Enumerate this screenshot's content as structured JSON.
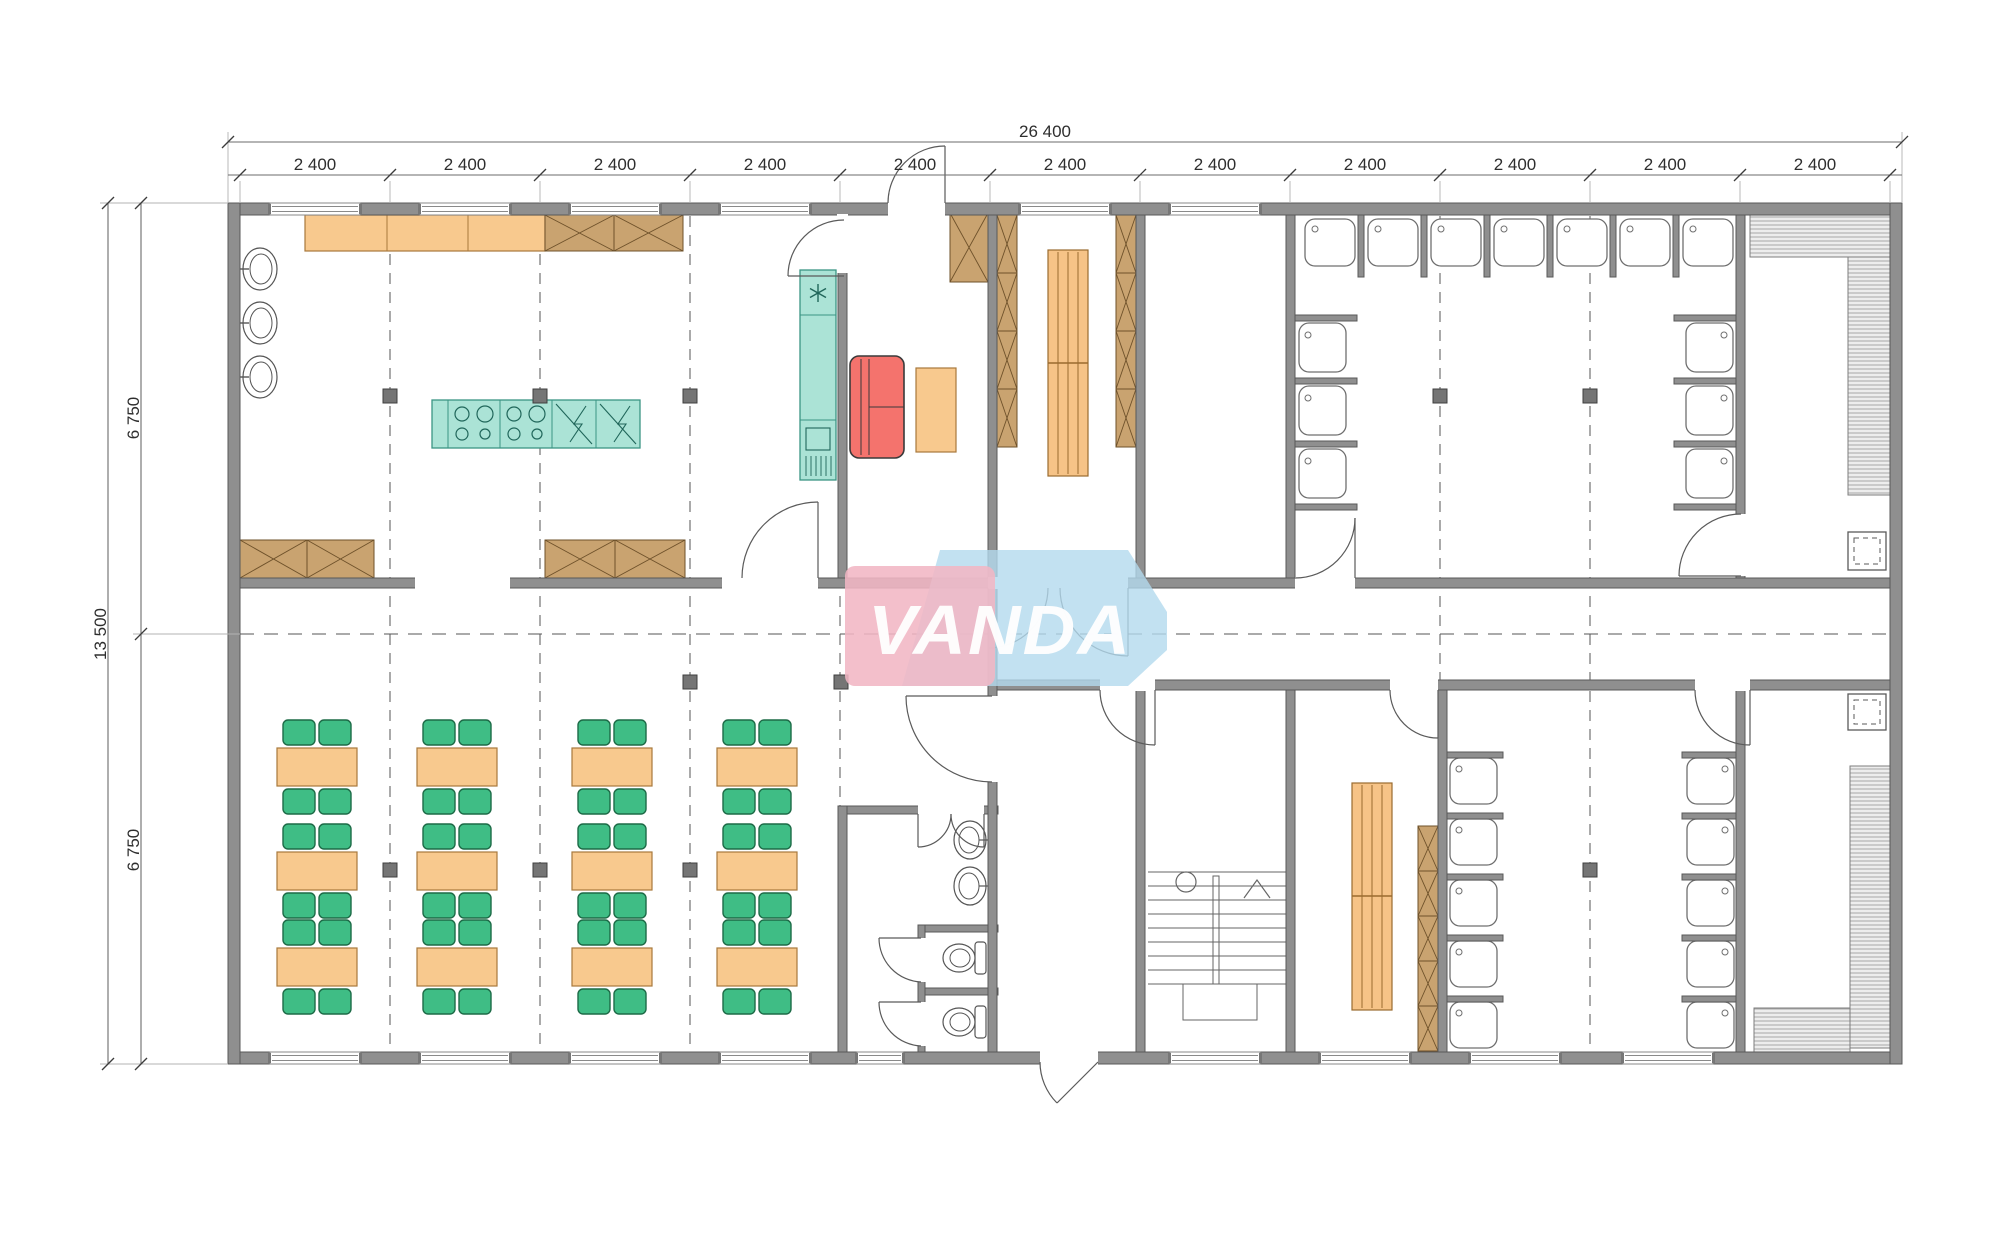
{
  "drawing": {
    "type": "architectural-floor-plan",
    "watermark": "VANDA"
  },
  "dims": {
    "total_width": "26 400",
    "bay_labels": [
      "2 400",
      "2 400",
      "2 400",
      "2 400",
      "2 400",
      "2 400",
      "2 400",
      "2 400",
      "2 400",
      "2 400",
      "2 400"
    ],
    "total_height": "13 500",
    "left_segments": [
      "6 750",
      "6 750"
    ]
  },
  "logo": {
    "text": "VANDA",
    "pink": "#f1b6c4",
    "blue": "#b3d9ee",
    "text_color": "#ffffff"
  },
  "colors": {
    "wall": "#8f8f8f",
    "furniture_orange": "#f8c98e",
    "cabinet_brown": "#c9a370",
    "kitchen_teal": "#abe3d6",
    "sofa_red": "#f4736d",
    "chair_green": "#3fbd85",
    "bench_hatch_bg": "#ededed",
    "line": "#5a5a5a"
  },
  "symbols": {
    "freezer_symbol": "✳"
  },
  "inventory": {
    "dining_tables": 12,
    "chairs_per_table": 4,
    "kitchen_wall_sinks": 3,
    "cooktop_modules": 2,
    "dishwasher_modules": 2,
    "shower_stalls_top_room": 13,
    "shower_stalls_bottom_room": 10,
    "wc_stalls": 2,
    "washbasins": 2,
    "locker_strips": 3,
    "changing_benches": 3,
    "saunas": 2,
    "sauna_heaters": 2,
    "staircases": 1
  }
}
